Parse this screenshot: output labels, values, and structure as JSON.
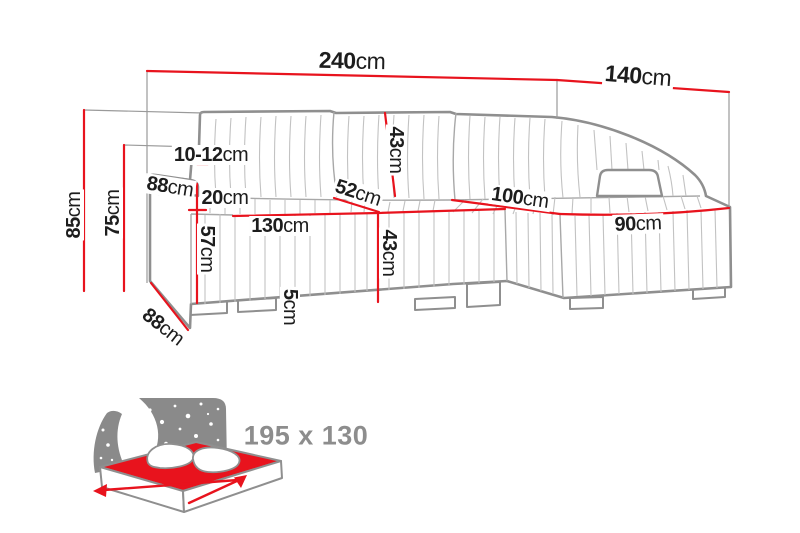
{
  "colors": {
    "dimension_red": "#e8131d",
    "outline_gray": "#8f8f8f",
    "pleat_gray": "#c2c2c2",
    "reference_gray": "#9a9a9a",
    "label_black": "#1d1d1d",
    "badge_gray": "#8d8d8d"
  },
  "labels": {
    "d240": {
      "value": "240",
      "unit": "cm"
    },
    "d140": {
      "value": "140",
      "unit": "cm"
    },
    "d85": {
      "value": "85",
      "unit": "cm"
    },
    "d75": {
      "value": "75",
      "unit": "cm"
    },
    "d10_12": {
      "value": "10-12",
      "unit": "cm"
    },
    "d88_arm": {
      "value": "88",
      "unit": "cm"
    },
    "d20": {
      "value": "20",
      "unit": "cm"
    },
    "d57": {
      "value": "57",
      "unit": "cm"
    },
    "d130": {
      "value": "130",
      "unit": "cm"
    },
    "d43_back": {
      "value": "43",
      "unit": "cm"
    },
    "d52": {
      "value": "52",
      "unit": "cm"
    },
    "d43_front": {
      "value": "43",
      "unit": "cm"
    },
    "d5": {
      "value": "5",
      "unit": "cm"
    },
    "d100": {
      "value": "100",
      "unit": "cm"
    },
    "d90": {
      "value": "90",
      "unit": "cm"
    },
    "d88_floor": {
      "value": "88",
      "unit": "cm"
    }
  },
  "bed_badge": {
    "icon": "sleeping-area-icon",
    "size_label": "195 x 130"
  }
}
